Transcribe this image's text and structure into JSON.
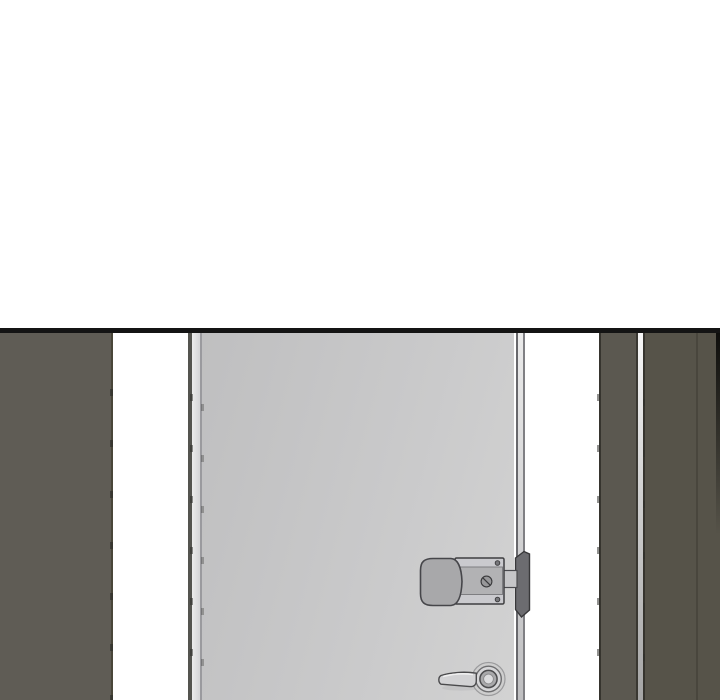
{
  "scene": {
    "type": "comic-panel-illustration",
    "description": "Monochrome webtoon panel: a closed light-gray door with a surface-mounted deadbolt lock and a lever handle, viewed between dark wall panels; blank white space above the panel.",
    "objects": {
      "left_wall": "dark wall panel on the left",
      "door_frame": "hinge-side door frame strip",
      "door": "light gray door leaf",
      "deadbolt_lock": "surface-mounted deadbolt lock with screw head",
      "latch_bolt": "bolt bridging door and frame",
      "strike_keeper": "dark strike keeper on the frame",
      "door_handle": "lever handle with round rose",
      "right_wall": "two dark wall panels with a bright corner highlight"
    },
    "colors": {
      "background": "#ffffff",
      "panel_border": "#141414",
      "left_wall": "#5f5c55",
      "right_wall_near": "#5b5850",
      "right_wall_far": "#565349",
      "door_dark": "#bfbfc0",
      "door_light": "#d2d2d2",
      "lock_body": "#a8a8aa",
      "lock_plate": "#c6c6c8",
      "lock_band": "#b2b2b4",
      "keeper": "#6c6c70",
      "bolt": "#c6c6c8",
      "handle_fill": "#d2d2d4",
      "handle_collar": "#a9a9ab",
      "outline": "#46464a"
    }
  }
}
